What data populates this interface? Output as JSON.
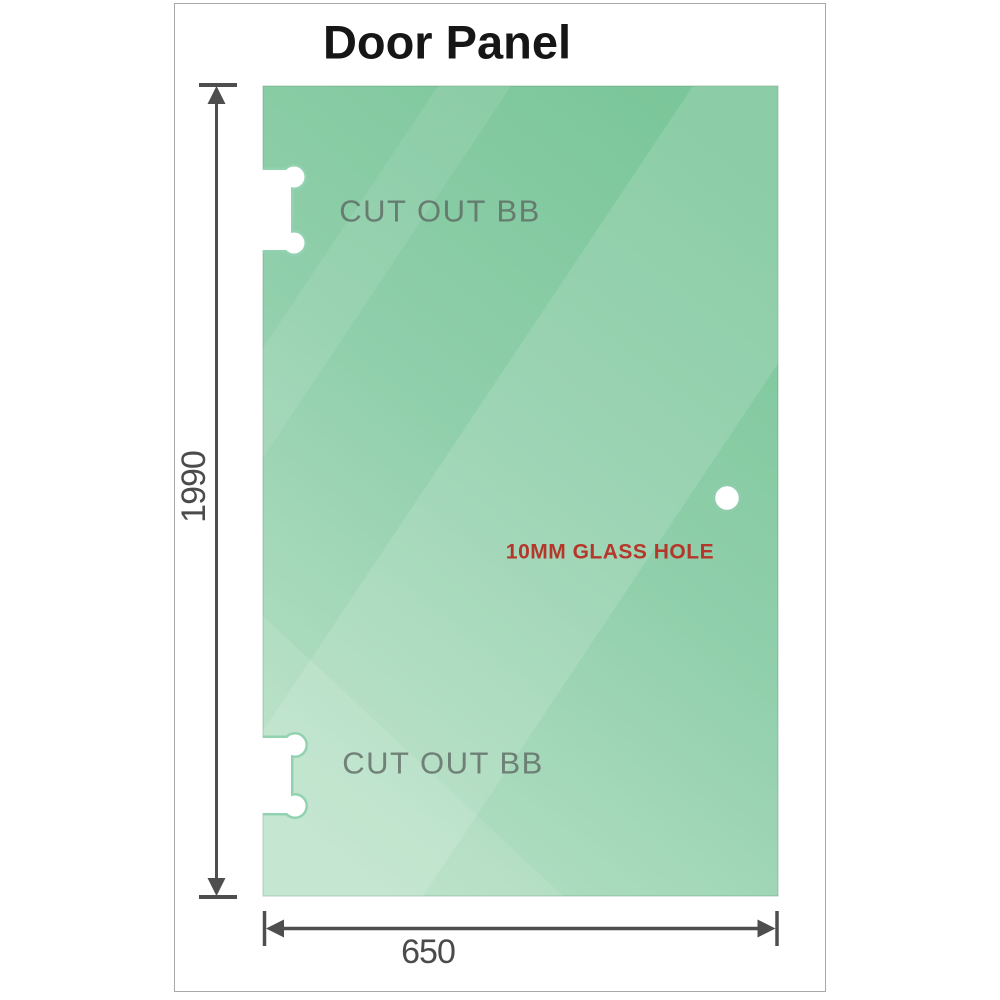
{
  "title": "Door Panel",
  "panel": {
    "cutouts": [
      {
        "label": "CUT OUT BB"
      },
      {
        "label": "CUT OUT BB"
      }
    ],
    "hole": {
      "label": "10MM GLASS HOLE"
    }
  },
  "dimensions": {
    "height": "1990",
    "width": "650"
  },
  "colors": {
    "glass_top": "#7bc69a",
    "glass_mid": "#90cfab",
    "glass_bottom": "#b6e0c5",
    "glass_edge": "#6fae8d",
    "dimension": "#4e4e4e",
    "dimension_text": "#4b4b4b",
    "cutout_label_text": "#5e6963",
    "hole_label_text": "#b5372b",
    "frame_border": "#a9a9a9",
    "title_text": "#161616",
    "hole_ring": "#8fcdad"
  }
}
